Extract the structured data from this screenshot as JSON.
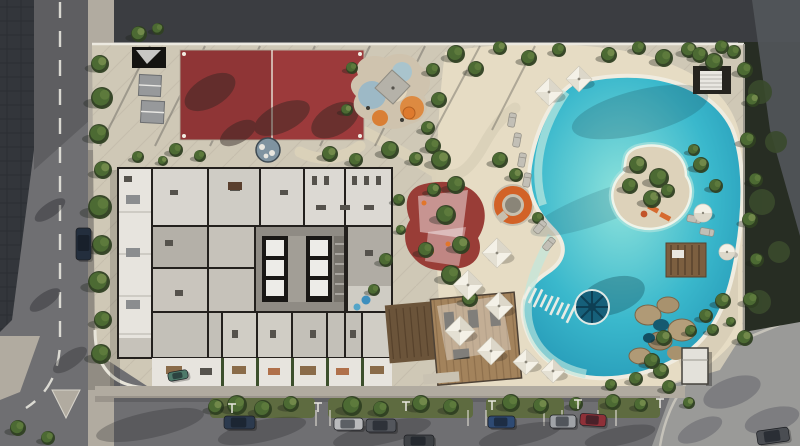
{
  "scene": {
    "name": "aerial-residential-site-plan-render",
    "canvas": {
      "width": 800,
      "height": 446
    }
  },
  "palette": {
    "asphalt": "#6f6f72",
    "asphalt_dark": "#5b5b5f",
    "dark_band": "#3b3d41",
    "roof_dark": "#33363b",
    "veg_dark": "#272d23",
    "plaza": "#9a9a98",
    "sidewalk": "#b1aba0",
    "concrete": "#cfc8b6",
    "beach": "#e6dcc4",
    "beach_shade": "#d9cfb8",
    "island_sand": "#ddd2ba",
    "court_red": "#9c3a3b",
    "pad_red": "#993d37",
    "pool_light": "#8fe3dc",
    "pool_mid": "#3ab8cc",
    "pool_deep": "#1f8fb0",
    "pool_rim": "#f0ece0",
    "wheel_teal": "#16607a",
    "wood_deck": "#a3835c",
    "wood_dark": "#6b543a",
    "orange": "#d26227",
    "floor_mid": "#c6c2ba",
    "floor_light": "#d8d5cf",
    "terrace_white": "#e7e4de",
    "wall_dark": "#23201d",
    "white_wall": "#ece9e0",
    "green_dark": "#2f4022",
    "green_mid": "#4c6a33",
    "green_light": "#71894a",
    "umbrella_light": "#f4f1e7",
    "umbrella_shade": "#d7d2c3",
    "lounger": "#c2bfb6",
    "lamp_white": "#e9e7df"
  },
  "objects": {
    "trees": [
      {
        "x": 100,
        "y": 64,
        "r": 9
      },
      {
        "x": 102,
        "y": 98,
        "r": 11
      },
      {
        "x": 99,
        "y": 134,
        "r": 10
      },
      {
        "x": 103,
        "y": 170,
        "r": 9
      },
      {
        "x": 100,
        "y": 207,
        "r": 12
      },
      {
        "x": 102,
        "y": 245,
        "r": 10
      },
      {
        "x": 99,
        "y": 282,
        "r": 11
      },
      {
        "x": 103,
        "y": 320,
        "r": 9
      },
      {
        "x": 101,
        "y": 354,
        "r": 10
      },
      {
        "x": 139,
        "y": 34,
        "r": 8
      },
      {
        "x": 158,
        "y": 29,
        "r": 6
      },
      {
        "x": 138,
        "y": 157,
        "r": 6
      },
      {
        "x": 163,
        "y": 161,
        "r": 5
      },
      {
        "x": 176,
        "y": 150,
        "r": 7
      },
      {
        "x": 200,
        "y": 156,
        "r": 6
      },
      {
        "x": 330,
        "y": 154,
        "r": 8
      },
      {
        "x": 356,
        "y": 160,
        "r": 7
      },
      {
        "x": 390,
        "y": 150,
        "r": 9
      },
      {
        "x": 416,
        "y": 159,
        "r": 7
      },
      {
        "x": 433,
        "y": 146,
        "r": 8
      },
      {
        "x": 352,
        "y": 68,
        "r": 6
      },
      {
        "x": 347,
        "y": 110,
        "r": 6
      },
      {
        "x": 433,
        "y": 70,
        "r": 7
      },
      {
        "x": 439,
        "y": 100,
        "r": 8
      },
      {
        "x": 428,
        "y": 128,
        "r": 7
      },
      {
        "x": 456,
        "y": 54,
        "r": 9
      },
      {
        "x": 476,
        "y": 69,
        "r": 8
      },
      {
        "x": 500,
        "y": 48,
        "r": 7
      },
      {
        "x": 529,
        "y": 58,
        "r": 8
      },
      {
        "x": 559,
        "y": 50,
        "r": 7
      },
      {
        "x": 609,
        "y": 55,
        "r": 8
      },
      {
        "x": 639,
        "y": 48,
        "r": 7
      },
      {
        "x": 664,
        "y": 58,
        "r": 9
      },
      {
        "x": 689,
        "y": 50,
        "r": 8
      },
      {
        "x": 714,
        "y": 62,
        "r": 9
      },
      {
        "x": 734,
        "y": 52,
        "r": 7
      },
      {
        "x": 441,
        "y": 160,
        "r": 10
      },
      {
        "x": 456,
        "y": 185,
        "r": 9
      },
      {
        "x": 446,
        "y": 215,
        "r": 10
      },
      {
        "x": 461,
        "y": 245,
        "r": 9
      },
      {
        "x": 451,
        "y": 275,
        "r": 10
      },
      {
        "x": 470,
        "y": 299,
        "r": 8
      },
      {
        "x": 434,
        "y": 190,
        "r": 7
      },
      {
        "x": 426,
        "y": 250,
        "r": 8
      },
      {
        "x": 500,
        "y": 160,
        "r": 8
      },
      {
        "x": 516,
        "y": 175,
        "r": 7
      },
      {
        "x": 538,
        "y": 218,
        "r": 6
      },
      {
        "x": 399,
        "y": 200,
        "r": 6
      },
      {
        "x": 401,
        "y": 230,
        "r": 5
      },
      {
        "x": 386,
        "y": 260,
        "r": 7
      },
      {
        "x": 374,
        "y": 290,
        "r": 6
      },
      {
        "x": 638,
        "y": 165,
        "r": 9
      },
      {
        "x": 659,
        "y": 178,
        "r": 10
      },
      {
        "x": 630,
        "y": 186,
        "r": 8
      },
      {
        "x": 652,
        "y": 199,
        "r": 9
      },
      {
        "x": 668,
        "y": 191,
        "r": 7
      },
      {
        "x": 745,
        "y": 70,
        "r": 8
      },
      {
        "x": 753,
        "y": 100,
        "r": 7
      },
      {
        "x": 748,
        "y": 140,
        "r": 8
      },
      {
        "x": 756,
        "y": 180,
        "r": 7
      },
      {
        "x": 750,
        "y": 220,
        "r": 8
      },
      {
        "x": 757,
        "y": 260,
        "r": 7
      },
      {
        "x": 751,
        "y": 300,
        "r": 8
      },
      {
        "x": 745,
        "y": 338,
        "r": 8
      },
      {
        "x": 700,
        "y": 55,
        "r": 8
      },
      {
        "x": 722,
        "y": 47,
        "r": 7
      },
      {
        "x": 701,
        "y": 165,
        "r": 8
      },
      {
        "x": 716,
        "y": 186,
        "r": 7
      },
      {
        "x": 694,
        "y": 150,
        "r": 6
      },
      {
        "x": 723,
        "y": 301,
        "r": 8
      },
      {
        "x": 706,
        "y": 316,
        "r": 7
      },
      {
        "x": 691,
        "y": 331,
        "r": 6
      },
      {
        "x": 661,
        "y": 371,
        "r": 8
      },
      {
        "x": 636,
        "y": 379,
        "r": 7
      },
      {
        "x": 611,
        "y": 385,
        "r": 6
      },
      {
        "x": 664,
        "y": 338,
        "r": 8
      },
      {
        "x": 652,
        "y": 361,
        "r": 8
      },
      {
        "x": 669,
        "y": 387,
        "r": 7
      },
      {
        "x": 689,
        "y": 403,
        "r": 6
      },
      {
        "x": 713,
        "y": 330,
        "r": 6
      },
      {
        "x": 731,
        "y": 322,
        "r": 5
      },
      {
        "x": 216,
        "y": 407,
        "r": 8
      },
      {
        "x": 237,
        "y": 405,
        "r": 10
      },
      {
        "x": 263,
        "y": 409,
        "r": 9
      },
      {
        "x": 291,
        "y": 404,
        "r": 8
      },
      {
        "x": 352,
        "y": 406,
        "r": 10
      },
      {
        "x": 381,
        "y": 409,
        "r": 8
      },
      {
        "x": 421,
        "y": 404,
        "r": 9
      },
      {
        "x": 451,
        "y": 407,
        "r": 8
      },
      {
        "x": 511,
        "y": 403,
        "r": 9
      },
      {
        "x": 541,
        "y": 406,
        "r": 8
      },
      {
        "x": 576,
        "y": 404,
        "r": 7
      },
      {
        "x": 613,
        "y": 402,
        "r": 8
      },
      {
        "x": 641,
        "y": 405,
        "r": 7
      },
      {
        "x": 18,
        "y": 428,
        "r": 8
      },
      {
        "x": 48,
        "y": 438,
        "r": 7
      }
    ],
    "umbrellas": [
      {
        "x": 549,
        "y": 92,
        "s": 14
      },
      {
        "x": 579,
        "y": 79,
        "s": 13
      },
      {
        "x": 497,
        "y": 253,
        "s": 15
      },
      {
        "x": 468,
        "y": 285,
        "s": 15
      },
      {
        "x": 499,
        "y": 306,
        "s": 14
      },
      {
        "x": 460,
        "y": 331,
        "s": 15
      },
      {
        "x": 491,
        "y": 351,
        "s": 14
      },
      {
        "x": 526,
        "y": 362,
        "s": 13
      },
      {
        "x": 553,
        "y": 371,
        "s": 12
      }
    ],
    "round_umbrellas": [
      {
        "x": 703,
        "y": 213,
        "r": 9
      },
      {
        "x": 727,
        "y": 252,
        "r": 8
      }
    ],
    "loungers": [
      {
        "x": 512,
        "y": 120,
        "a": 10
      },
      {
        "x": 517,
        "y": 140,
        "a": 10
      },
      {
        "x": 522,
        "y": 160,
        "a": 10
      },
      {
        "x": 527,
        "y": 180,
        "a": 10
      },
      {
        "x": 540,
        "y": 227,
        "a": 40
      },
      {
        "x": 549,
        "y": 244,
        "a": 40
      },
      {
        "x": 694,
        "y": 219,
        "a": 100
      },
      {
        "x": 707,
        "y": 232,
        "a": 100
      }
    ],
    "cars": [
      {
        "x": 76,
        "y": 228,
        "w": 15,
        "h": 32,
        "c": "#232e3d",
        "a": 0
      },
      {
        "x": 224,
        "y": 416,
        "w": 31,
        "h": 13,
        "c": "#2c3a4e",
        "a": 0
      },
      {
        "x": 334,
        "y": 418,
        "w": 29,
        "h": 12,
        "c": "#b9babc",
        "a": 0
      },
      {
        "x": 366,
        "y": 419,
        "w": 30,
        "h": 13,
        "c": "#53565c",
        "a": 0
      },
      {
        "x": 488,
        "y": 416,
        "w": 27,
        "h": 12,
        "c": "#2e4a73",
        "a": 0
      },
      {
        "x": 550,
        "y": 415,
        "w": 26,
        "h": 13,
        "c": "#a0a3a7",
        "a": 0
      },
      {
        "x": 580,
        "y": 414,
        "w": 26,
        "h": 12,
        "c": "#8e3038",
        "a": 4
      },
      {
        "x": 404,
        "y": 435,
        "w": 30,
        "h": 12,
        "c": "#3f4246",
        "a": 0
      },
      {
        "x": 757,
        "y": 429,
        "w": 32,
        "h": 14,
        "c": "#4a4d52",
        "a": -8
      },
      {
        "x": 168,
        "y": 371,
        "w": 20,
        "h": 9,
        "c": "#4e7a6a",
        "a": -10
      }
    ],
    "lamps": [
      {
        "x": 232,
        "y": 404
      },
      {
        "x": 318,
        "y": 403
      },
      {
        "x": 406,
        "y": 402
      },
      {
        "x": 492,
        "y": 401
      },
      {
        "x": 578,
        "y": 400
      },
      {
        "x": 660,
        "y": 399
      }
    ],
    "bridge": {
      "x1": 527,
      "y1": 293,
      "x2": 571,
      "y2": 314,
      "n": 9,
      "len": 17
    }
  }
}
